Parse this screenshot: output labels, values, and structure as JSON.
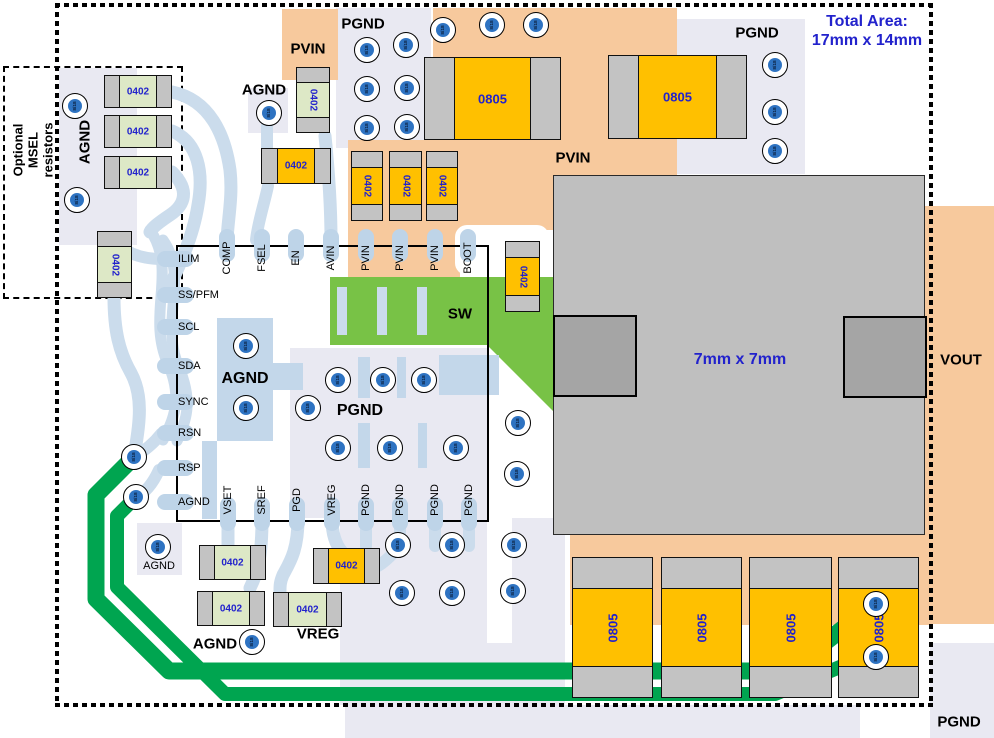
{
  "texts": {
    "total_area_1": "Total Area:",
    "total_area_2": "17mm x 14mm",
    "chip": "7mm x 7mm",
    "via": "8/18",
    "msel_1": "Optional",
    "msel_2": "MSEL",
    "msel_3": "resistors"
  },
  "colors": {
    "lavender": "#e9e9f2",
    "orange_pour": "#f7c99d",
    "sw_green": "#78c246",
    "trace_green": "#00a550",
    "trace_blue": "#cbdcec",
    "pad_blue": "#bed4e8",
    "comp_green": "#dde8c6",
    "comp_orange": "#ffc000",
    "cap_gray": "#c3c3c3",
    "chip_gray": "#bfbfbf",
    "tab_gray": "#a5a5a5",
    "via_blue": "#2e73c2",
    "label_blue": "#2222cc"
  },
  "ic_pins": {
    "top": [
      {
        "x": 227,
        "t": "COMP"
      },
      {
        "x": 262,
        "t": "FSEL"
      },
      {
        "x": 296,
        "t": "EN"
      },
      {
        "x": 331,
        "t": "AVIN"
      },
      {
        "x": 366,
        "t": "PVIN"
      },
      {
        "x": 400,
        "t": "PVIN"
      },
      {
        "x": 435,
        "t": "PVIN"
      },
      {
        "x": 468,
        "t": "BOOT"
      }
    ],
    "left": [
      {
        "y": 259,
        "t": "ILIM"
      },
      {
        "y": 295,
        "t": "SS/PFM"
      },
      {
        "y": 327,
        "t": "SCL"
      },
      {
        "y": 366,
        "t": "SDA"
      },
      {
        "y": 402,
        "t": "SYNC"
      },
      {
        "y": 433,
        "t": "RSN"
      },
      {
        "y": 468,
        "t": "RSP"
      },
      {
        "y": 502,
        "t": "AGND"
      }
    ],
    "bottom": [
      {
        "x": 228,
        "t": "VSET"
      },
      {
        "x": 262,
        "t": "SREF"
      },
      {
        "x": 297,
        "t": "PGD"
      },
      {
        "x": 332,
        "t": "VREG"
      },
      {
        "x": 366,
        "t": "PGND"
      },
      {
        "x": 400,
        "t": "PGND"
      },
      {
        "x": 435,
        "t": "PGND"
      },
      {
        "x": 469,
        "t": "PGND"
      }
    ]
  },
  "labels": [
    {
      "name": "pgnd-top",
      "text": "PGND",
      "x": 363,
      "y": 24,
      "size": 15,
      "bold": true
    },
    {
      "name": "agnd-top",
      "text": "AGND",
      "x": 264,
      "y": 90,
      "size": 15,
      "bold": true
    },
    {
      "name": "pvin-top",
      "text": "PVIN",
      "x": 308,
      "y": 49,
      "size": 15,
      "bold": true
    },
    {
      "name": "pvin-mid",
      "text": "PVIN",
      "x": 573,
      "y": 158,
      "size": 15,
      "bold": true
    },
    {
      "name": "pgnd-topright",
      "text": "PGND",
      "x": 757,
      "y": 33,
      "size": 15,
      "bold": true
    },
    {
      "name": "agnd-left-vert",
      "text": "AGND",
      "x": 85,
      "y": 142,
      "size": 15,
      "bold": true,
      "rot": -90
    },
    {
      "name": "sw",
      "text": "SW",
      "x": 460,
      "y": 314,
      "size": 15,
      "bold": true
    },
    {
      "name": "agnd-ic",
      "text": "AGND",
      "x": 245,
      "y": 379,
      "size": 16,
      "bold": true
    },
    {
      "name": "pgnd-ic",
      "text": "PGND",
      "x": 360,
      "y": 411,
      "size": 16,
      "bold": true
    },
    {
      "name": "agnd-via-small",
      "text": "AGND",
      "x": 159,
      "y": 566,
      "size": 11,
      "bold": false
    },
    {
      "name": "agnd-bottom",
      "text": "AGND",
      "x": 215,
      "y": 644,
      "size": 15,
      "bold": true
    },
    {
      "name": "vreg",
      "text": "VREG",
      "x": 318,
      "y": 634,
      "size": 15,
      "bold": true
    },
    {
      "name": "vout",
      "text": "VOUT",
      "x": 961,
      "y": 360,
      "size": 15,
      "bold": true
    },
    {
      "name": "pgnd-bottomright",
      "text": "PGND",
      "x": 959,
      "y": 722,
      "size": 15,
      "bold": true
    }
  ],
  "components": [
    {
      "t": "g",
      "l": "0402",
      "x": 104,
      "y": 75,
      "w": 68,
      "h": 33,
      "o": "h"
    },
    {
      "t": "g",
      "l": "0402",
      "x": 104,
      "y": 115,
      "w": 68,
      "h": 33,
      "o": "h"
    },
    {
      "t": "g",
      "l": "0402",
      "x": 104,
      "y": 156,
      "w": 68,
      "h": 33,
      "o": "h"
    },
    {
      "t": "g",
      "l": "0402",
      "x": 296,
      "y": 67,
      "w": 34,
      "h": 66,
      "o": "v"
    },
    {
      "t": "g",
      "l": "0402",
      "x": 97,
      "y": 231,
      "w": 35,
      "h": 67,
      "o": "v"
    },
    {
      "t": "g",
      "l": "0402",
      "x": 199,
      "y": 545,
      "w": 67,
      "h": 35,
      "o": "h"
    },
    {
      "t": "g",
      "l": "0402",
      "x": 197,
      "y": 591,
      "w": 68,
      "h": 35,
      "o": "h"
    },
    {
      "t": "g",
      "l": "0402",
      "x": 273,
      "y": 592,
      "w": 69,
      "h": 35,
      "o": "h"
    },
    {
      "t": "o",
      "l": "0402",
      "x": 261,
      "y": 148,
      "w": 70,
      "h": 36,
      "o": "h"
    },
    {
      "t": "o",
      "l": "0402",
      "x": 351,
      "y": 151,
      "w": 32,
      "h": 70,
      "o": "v"
    },
    {
      "t": "o",
      "l": "0402",
      "x": 389,
      "y": 151,
      "w": 33,
      "h": 70,
      "o": "v"
    },
    {
      "t": "o",
      "l": "0402",
      "x": 426,
      "y": 151,
      "w": 32,
      "h": 70,
      "o": "v"
    },
    {
      "t": "o",
      "l": "0402",
      "x": 505,
      "y": 241,
      "w": 35,
      "h": 71,
      "o": "v"
    },
    {
      "t": "o",
      "l": "0402",
      "x": 313,
      "y": 548,
      "w": 67,
      "h": 36,
      "o": "h"
    },
    {
      "t": "b",
      "l": "0805",
      "x": 424,
      "y": 57,
      "w": 137,
      "h": 83,
      "o": "h"
    },
    {
      "t": "b",
      "l": "0805",
      "x": 608,
      "y": 55,
      "w": 139,
      "h": 84,
      "o": "h"
    },
    {
      "t": "b",
      "l": "0805",
      "x": 572,
      "y": 557,
      "w": 81,
      "h": 141,
      "o": "v"
    },
    {
      "t": "b",
      "l": "0805",
      "x": 661,
      "y": 557,
      "w": 81,
      "h": 141,
      "o": "v"
    },
    {
      "t": "b",
      "l": "0805",
      "x": 749,
      "y": 557,
      "w": 83,
      "h": 141,
      "o": "v"
    },
    {
      "t": "b",
      "l": "0805",
      "x": 838,
      "y": 557,
      "w": 81,
      "h": 141,
      "o": "v"
    }
  ],
  "vias": [
    [
      75,
      106
    ],
    [
      77,
      200
    ],
    [
      269,
      113
    ],
    [
      367,
      50
    ],
    [
      406,
      45
    ],
    [
      367,
      89
    ],
    [
      407,
      88
    ],
    [
      367,
      128
    ],
    [
      407,
      127
    ],
    [
      443,
      30
    ],
    [
      492,
      25
    ],
    [
      536,
      25
    ],
    [
      775,
      65
    ],
    [
      775,
      112
    ],
    [
      775,
      151
    ],
    [
      246,
      346
    ],
    [
      246,
      408
    ],
    [
      308,
      408
    ],
    [
      338,
      380
    ],
    [
      383,
      380
    ],
    [
      424,
      380
    ],
    [
      338,
      448
    ],
    [
      390,
      448
    ],
    [
      456,
      448
    ],
    [
      518,
      423
    ],
    [
      517,
      474
    ],
    [
      398,
      545
    ],
    [
      452,
      545
    ],
    [
      514,
      545
    ],
    [
      402,
      593
    ],
    [
      452,
      593
    ],
    [
      513,
      591
    ],
    [
      134,
      457
    ],
    [
      136,
      497
    ],
    [
      158,
      547
    ],
    [
      252,
      642
    ],
    [
      876,
      604
    ],
    [
      876,
      657
    ]
  ]
}
